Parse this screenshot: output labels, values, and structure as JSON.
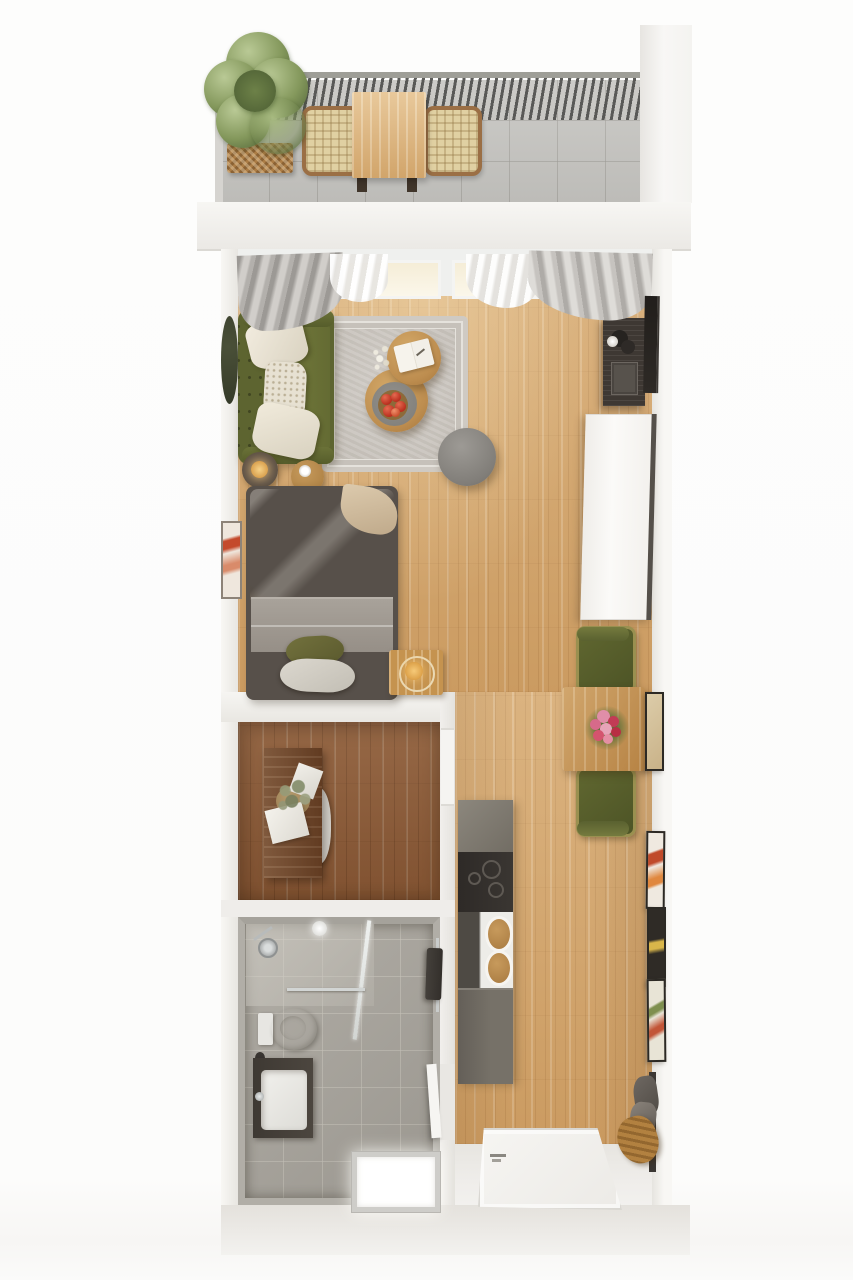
{
  "meta": {
    "title": "Studio apartment 3D floor plan — top-down render",
    "view": "top-down isometric render",
    "canvas": {
      "width_px": 853,
      "height_px": 1280
    },
    "visible_text": "none — image contains no text labels"
  },
  "palette": {
    "background": "#fdfdfc",
    "wall_white": "#f2f0ec",
    "oak_floor": "#d2a368",
    "walnut_floor": "#8a5936",
    "bath_tile": "#a8a49c",
    "balcony_tile": "#c7c6c2",
    "sofa_olive": "#5d6430",
    "chair_olive": "#596030",
    "wood_furniture": "#c5934f",
    "kitchen_gray": "#6f6a62",
    "cooktop_black": "#302c29",
    "duvet_beige": "#c4b094",
    "rug_gray": "#c9c4bd",
    "accent_glow": "#f6ca79"
  },
  "rooms": {
    "balcony": {
      "label": "Balcony terrace with slatted railing, gray tile floor",
      "items": {
        "railing": "Dark slatted balcony railing",
        "plant": "Large green shrub in woven planter box",
        "table": "Rectangular oak outdoor dining table",
        "bench_left": "Woven-seat outdoor bench (left)",
        "bench_right": "Woven-seat outdoor bench (right)"
      }
    },
    "living": {
      "label": "Living area with oak floor and window wall",
      "items": {
        "window": "Full-width window with warm daylight",
        "curtains": "Gray and white drapes at both window ends",
        "sofa": "Olive green tufted sofa with three cream pillows",
        "wall_mirror": "Dark round mirror on left wall",
        "rug": "Gray bordered area rug",
        "coffee_table_small": "Round nesting table with open notebook",
        "coffee_table_large": "Round nesting table with gray tray, apple bowl and dried flowers",
        "pouf": "Round gray pouf",
        "floor_lamp": "Glowing floor lamp",
        "side_table": "Small round wood side table with white cup",
        "vanity_desk": "Dark desk with lamp and laptop (right wall)",
        "leaning_mirror": "Dark leaning mirror on right wall",
        "wardrobe": "Tall white wardrobe along right wall"
      }
    },
    "sleeping": {
      "label": "Sleeping nook",
      "items": {
        "bed": "Double bed, beige duvet, gray throw, olive and light cushions",
        "wall_art": "Small abstract artwork on left wall",
        "bedside_lamp": "Wooden cube bedside lamp with glowing ring"
      }
    },
    "dining": {
      "label": "Dining corner by right wall",
      "items": {
        "table": "Square oak dining table",
        "flowers": "Pink and red bouquet centerpiece",
        "chair_top": "Olive upholstered chair (top)",
        "chair_bottom": "Olive upholstered chair (bottom)",
        "art_frame": "Beige abstract frame on wall"
      }
    },
    "study": {
      "label": "Study / dressing room with dark walnut floor",
      "items": {
        "desk": "Dark wood desk along left wall",
        "plant": "Dried sage plant in woven basket",
        "papers": "White papers on and beside desk",
        "chair": "White chair tucked under desk",
        "door": "Closed white door to hallway"
      }
    },
    "bathroom": {
      "label": "Bathroom with gray tile",
      "items": {
        "shower": "Corner shower with glass screen and chrome head",
        "ceiling_light": "Round ceiling spot",
        "toilet": "Wall-hung white toilet",
        "vanity": "Dark vanity with white basin and chrome faucet",
        "towel": "Dark towel on chrome rail (right wall)",
        "floor_panel": "Illuminated white shower floor panel",
        "door": "Door opening to entry hall"
      }
    },
    "kitchen": {
      "label": "Galley kitchenette strip facing hallway",
      "items": {
        "counter_top_section": "Gray counter section",
        "cooktop": "Black cooktop with burner rings",
        "sink": "White sink section with two wooden boards",
        "base_section": "Gray base cabinet section"
      }
    },
    "hallway": {
      "label": "Entry hallway with gallery wall",
      "items": {
        "gallery": "Three stacked art frames on right wall",
        "coat_rack": "Coat hooks with gray coats and tan scarf",
        "entry_door": "White entrance door (plan view)",
        "entry_floor": "Light entry flooring"
      }
    }
  }
}
